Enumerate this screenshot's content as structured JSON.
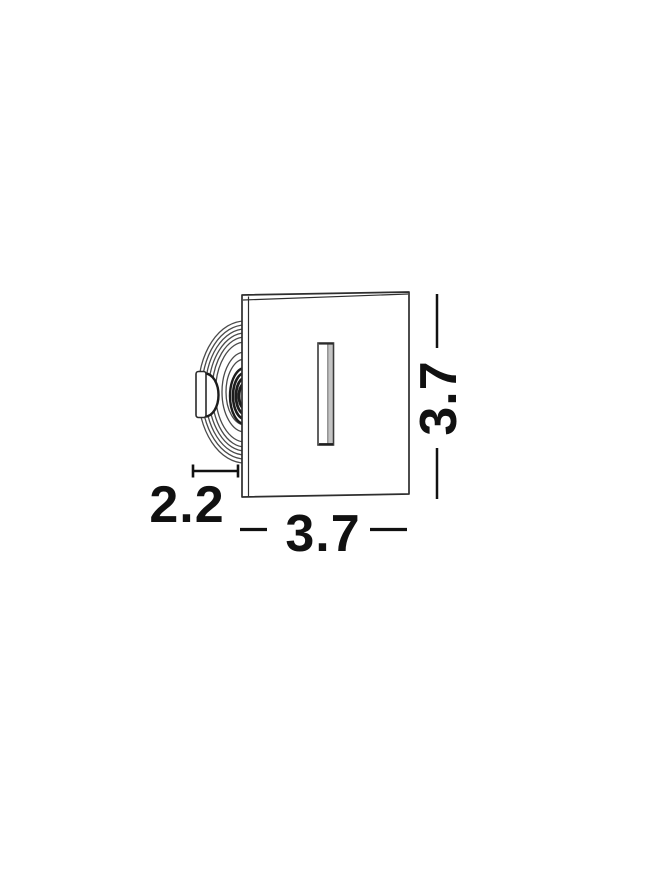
{
  "drawing": {
    "name": "recessed-step-light-dimension-drawing",
    "dimensions": {
      "depth": {
        "label": "2.2"
      },
      "width": {
        "label": "3.7"
      },
      "height": {
        "label": "3.7"
      }
    },
    "colors": {
      "background": "#ffffff",
      "outline": "#2e2e2e",
      "fin_line": "#4a4a4a",
      "thread_dark": "#1c1c1c",
      "dimension": "#111111",
      "slot_shade": "#c4c4c4"
    }
  }
}
